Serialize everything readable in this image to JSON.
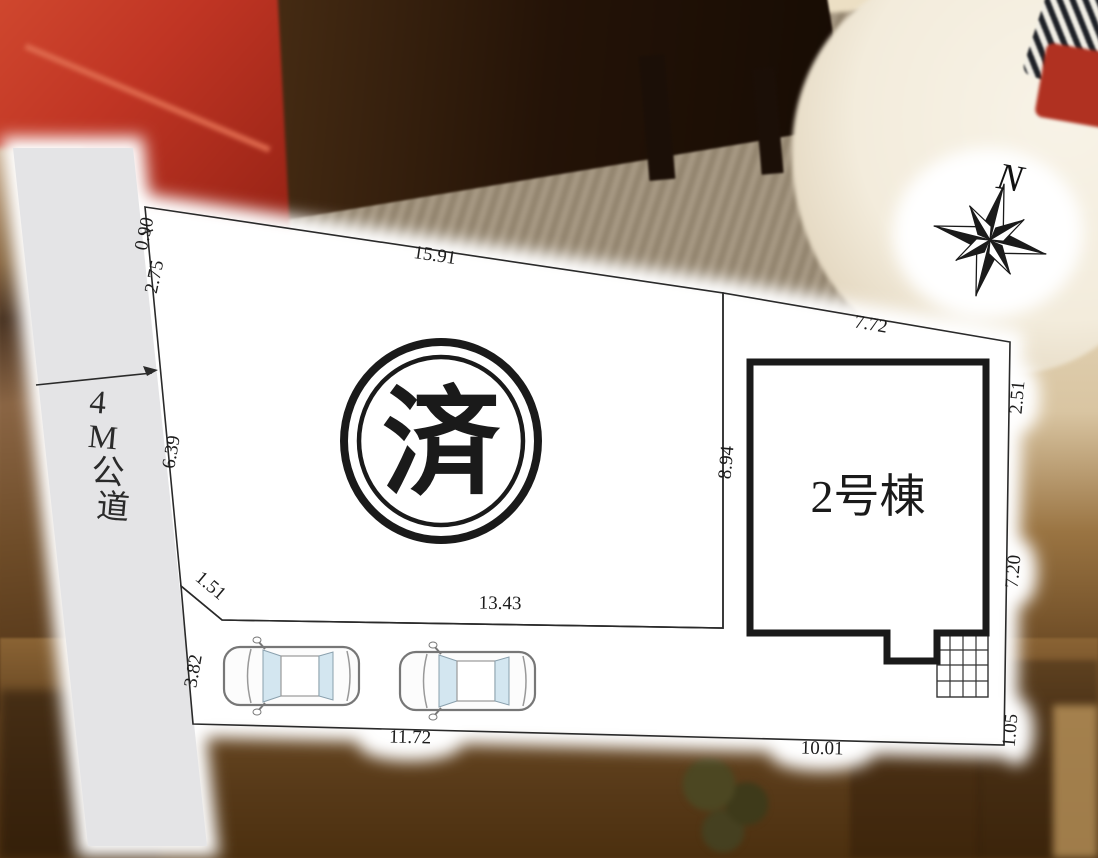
{
  "figure": {
    "type": "real-estate-plot-layout-diagram",
    "road": {
      "label": "4M公道",
      "chars": [
        "4",
        "M",
        "公",
        "道"
      ]
    },
    "stamp": {
      "label": "済",
      "meaning": "sold"
    },
    "building": {
      "label": "2号棟"
    },
    "compass": {
      "label": "N"
    },
    "parking": {
      "car_count": 2
    },
    "dimensions": {
      "top_edge": "15.91",
      "left_seg1": "0.90",
      "left_seg2": "2.75",
      "left_seg3": "6.39",
      "diagonal": "1.51",
      "parking_left": "3.82",
      "inner_bottom": "13.43",
      "parking_bottom": "11.72",
      "green_bottom": "10.01",
      "green_top": "7.72",
      "right_seg1": "2.51",
      "building_left": "8.94",
      "right_seg2": "7.20",
      "right_seg3": "1.05"
    },
    "colors": {
      "plot_white": "#ffffff",
      "road_gray": "#e4e4e6",
      "lawn_green": "#dbe7b6",
      "boundary_line": "#2a2a2a",
      "building_border": "#1a1a1a",
      "car_window_blue": "#d3e6f0",
      "photo_chair_red": "#c03524",
      "photo_table_brown": "#241307",
      "photo_floor_tan": "#ecdfc4",
      "photo_bottom_brown": "#6b4a24"
    }
  }
}
